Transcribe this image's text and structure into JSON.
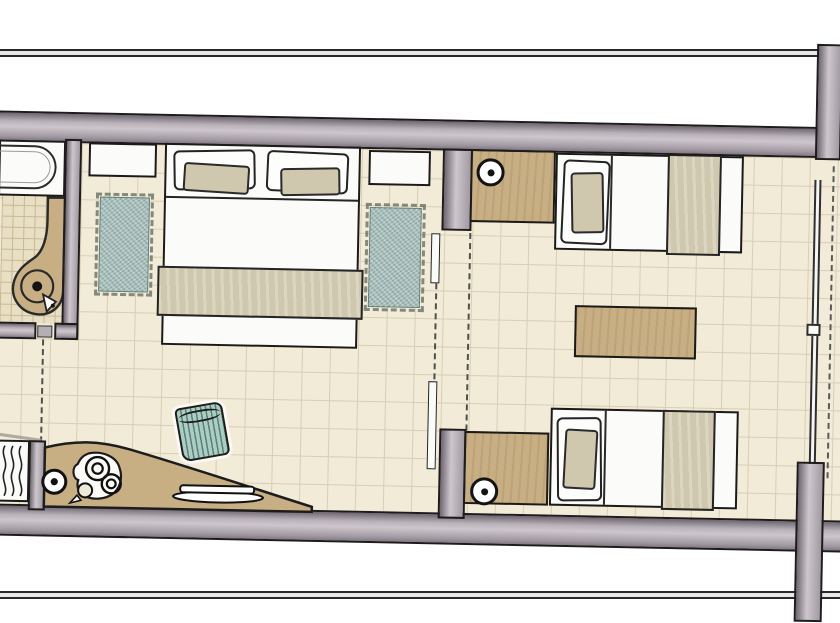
{
  "scene": {
    "type": "floor-plan",
    "description": "hand-drawn style top-view floor plan of a hotel suite",
    "rooms": [
      {
        "name": "bathroom",
        "furniture": [
          "bathtub",
          "wood-vanity-with-round-sink",
          "sink-faucet"
        ]
      },
      {
        "name": "bedroom",
        "furniture": [
          "double-bed",
          "pillows",
          "fold-blanket",
          "nightstand-left",
          "nightstand-right",
          "fringed-rug-left",
          "fringed-rug-right"
        ]
      },
      {
        "name": "entry-kitchenette",
        "furniture": [
          "radiator",
          "curved-kitchen-counter",
          "two-burner-cooktop",
          "kettle",
          "serving-plate",
          "round-counter-knob",
          "striped-stool"
        ]
      },
      {
        "name": "twin-room",
        "furniture": [
          "twin-bed-top",
          "twin-bed-bottom",
          "headboard-panel-top",
          "headboard-panel-bottom",
          "reading-light-knob-top",
          "reading-light-knob-bottom",
          "wood-side-table"
        ]
      }
    ],
    "openings": [
      "bathroom-door-dashed-swing",
      "sliding-partition-with-dashed-lines",
      "right-side-window-glass-line",
      "balcony-dashed-line"
    ]
  },
  "palette": {
    "line-dark": "#1d1b1c",
    "wall-light": "#cdc7cd",
    "wall-mid": "#a29aa2",
    "wall-deep": "#6f666f",
    "floor-bg": "#f2ebd8",
    "floor-line": "#d9ceb3",
    "bath-floor-bg": "#e9dfc5",
    "bath-floor-line": "#c7b994",
    "wood": "#c8ae83",
    "textile-beige": "#cfc8ae",
    "rug-teal": "#a5bfbb",
    "stool-teal": "#a9cfc4",
    "stool-stripe": "#5f7e76",
    "paper-white": "#fbfbfa",
    "dash-gray": "#4f4f4f"
  }
}
